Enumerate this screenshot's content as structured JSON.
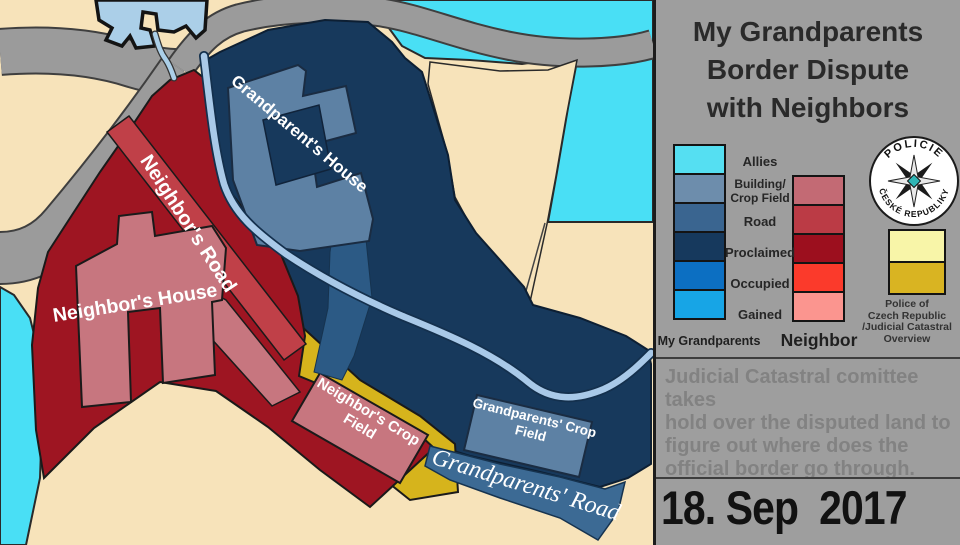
{
  "title": {
    "lines": [
      "My Grandparents",
      "Border Dispute",
      "with Neighbors"
    ]
  },
  "legend": {
    "rows": [
      {
        "label": "Allies"
      },
      {
        "label": "Building/",
        "label2": "Crop Field"
      },
      {
        "label": "Road"
      },
      {
        "label": "Proclaimed"
      },
      {
        "label": "Occupied"
      },
      {
        "label": "Gained"
      }
    ],
    "grandparents_swatches": [
      "#55dff2",
      "#6d8dac",
      "#3a6590",
      "#16395d",
      "#0c6fc2",
      "#17a5e6"
    ],
    "neighbor_swatches": [
      "#c36a74",
      "#bb3b45",
      "#9c0f1e",
      "#fb3a2b",
      "#fb958f"
    ],
    "col_label_grandparents": "My Grandparents",
    "col_label_neighbor": "Neighbor"
  },
  "badge": {
    "top_text": "POLICIE",
    "bottom_text": "ČESKÉ REPUBLIKY",
    "center_color": "#2fb5b5"
  },
  "judicial": {
    "caption_lines": [
      "Police of",
      "Czech Republic",
      "/Judicial Catastral",
      "Overview"
    ],
    "swatch_colors": [
      "#f8f5a8",
      "#d9b422"
    ]
  },
  "note": {
    "lines": [
      "Judicial Catastral comittee takes",
      "hold over the disputed land to",
      "figure out where does the",
      "official border go through."
    ]
  },
  "date": "18. Sep  2017",
  "map": {
    "labels": {
      "grandparents_house": "Grandparent's House",
      "neighbors_road": "Neighbor's Road",
      "neighbors_house": "Neighbor's House",
      "neighbors_crop_line1": "Neighbor's Crop",
      "neighbors_crop_line2": "Field",
      "grandparents_crop_line1": "Grandparents' Crop",
      "grandparents_crop_line2": "Field",
      "grandparents_road": "Grandparents' Road"
    },
    "colors": {
      "background_tan": "#f7e3ba",
      "allies_cyan": "#49dff5",
      "grandparents_proclaimed": "#17395c",
      "grandparents_building": "#5d81a4",
      "grandparents_road": "#3c6a94",
      "neighbor_proclaimed": "#9e1522",
      "neighbor_road": "#c04048",
      "neighbor_building": "#c7767f",
      "judicial_yellow": "#d6b41c",
      "road_gray": "#9b9b9b",
      "water_light": "#abcfe8"
    }
  }
}
